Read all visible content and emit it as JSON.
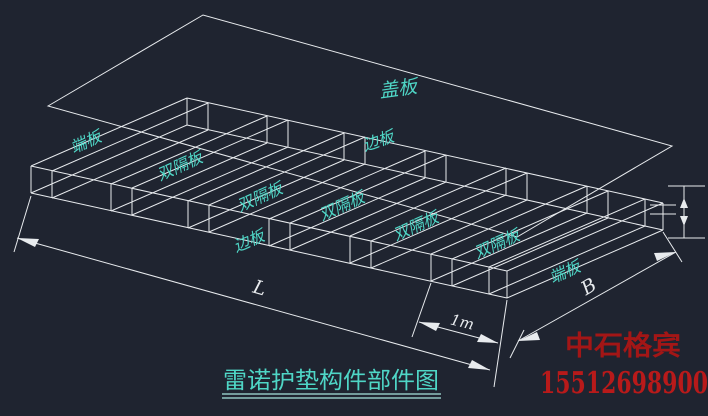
{
  "drawing": {
    "title": "雷诺护垫构件部件图",
    "watermark": {
      "company": "中石格宾",
      "phone": "15512698900"
    },
    "labels": {
      "cover": "盖板",
      "side_top": "边板",
      "side_bottom": "边板",
      "end_left": "端板",
      "end_right": "端板",
      "partition_1": "双隔板",
      "partition_2": "双隔板",
      "partition_3": "双隔板",
      "partition_4": "双隔板",
      "partition_5": "双隔板"
    },
    "dimensions": {
      "length": "L",
      "width": "B",
      "cell_width": "1m"
    },
    "colors": {
      "background": "#1f2430",
      "line": "#e8ebee",
      "label_cyan": "#4fd6c6",
      "company_red": "#a31616",
      "phone_red": "#b81a1a"
    }
  }
}
